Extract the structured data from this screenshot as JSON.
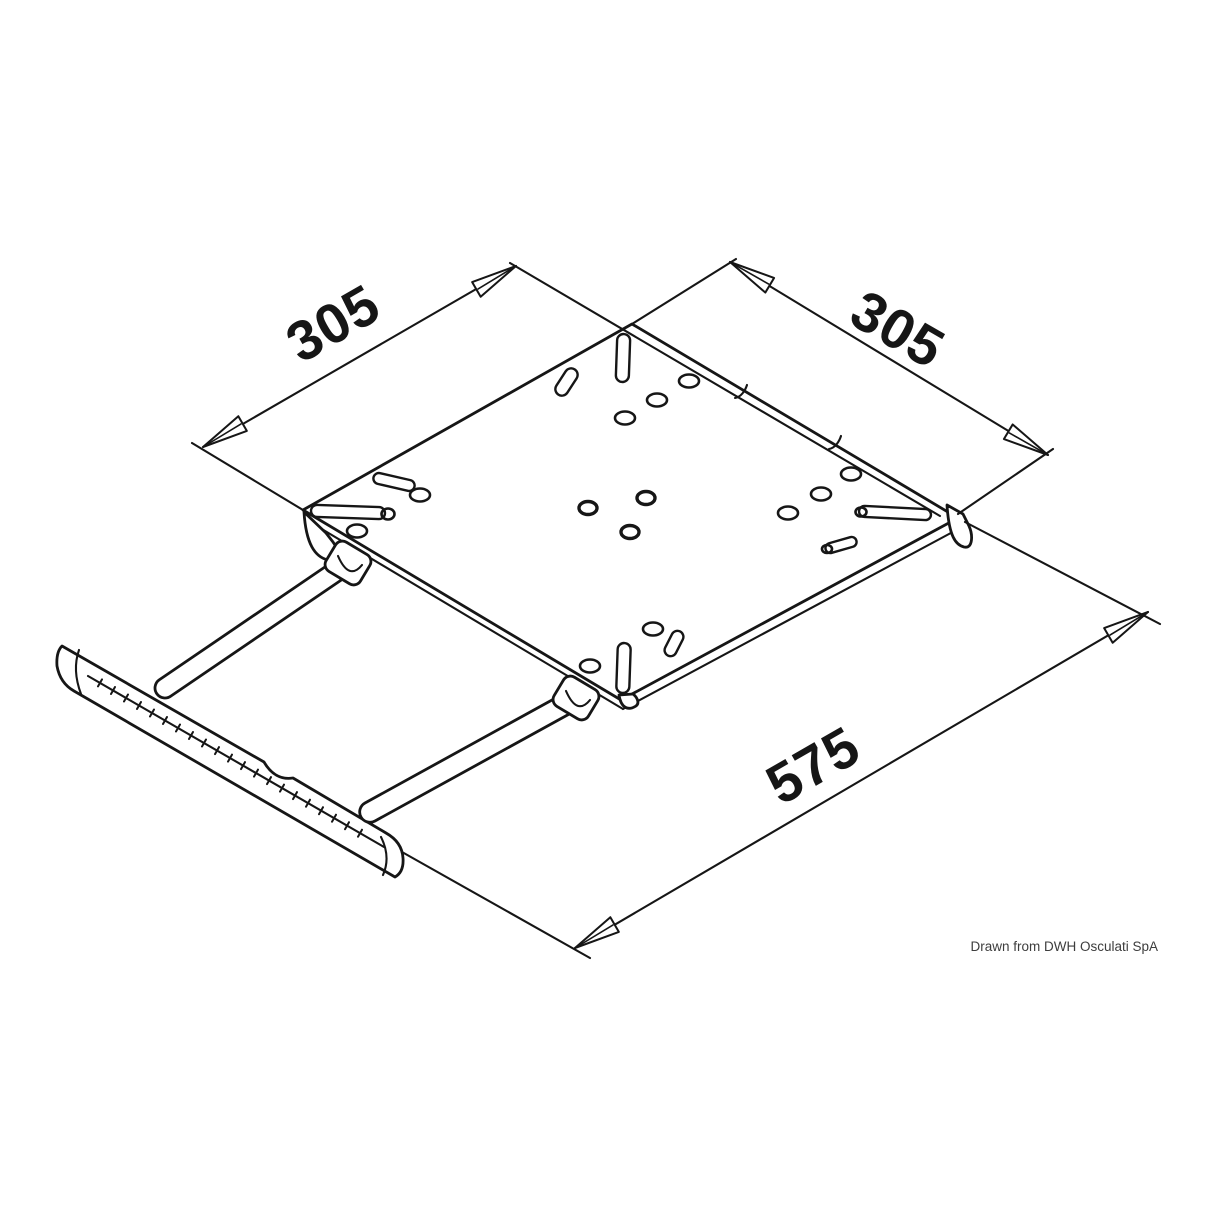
{
  "drawing": {
    "dimensions": {
      "plate_width": "305",
      "plate_depth": "305",
      "extended_length": "575"
    },
    "credit": "Drawn from DWH Osculati SpA",
    "colors": {
      "ink": "#161616",
      "credit_text": "#3d3d3d",
      "background": "#ffffff"
    }
  }
}
